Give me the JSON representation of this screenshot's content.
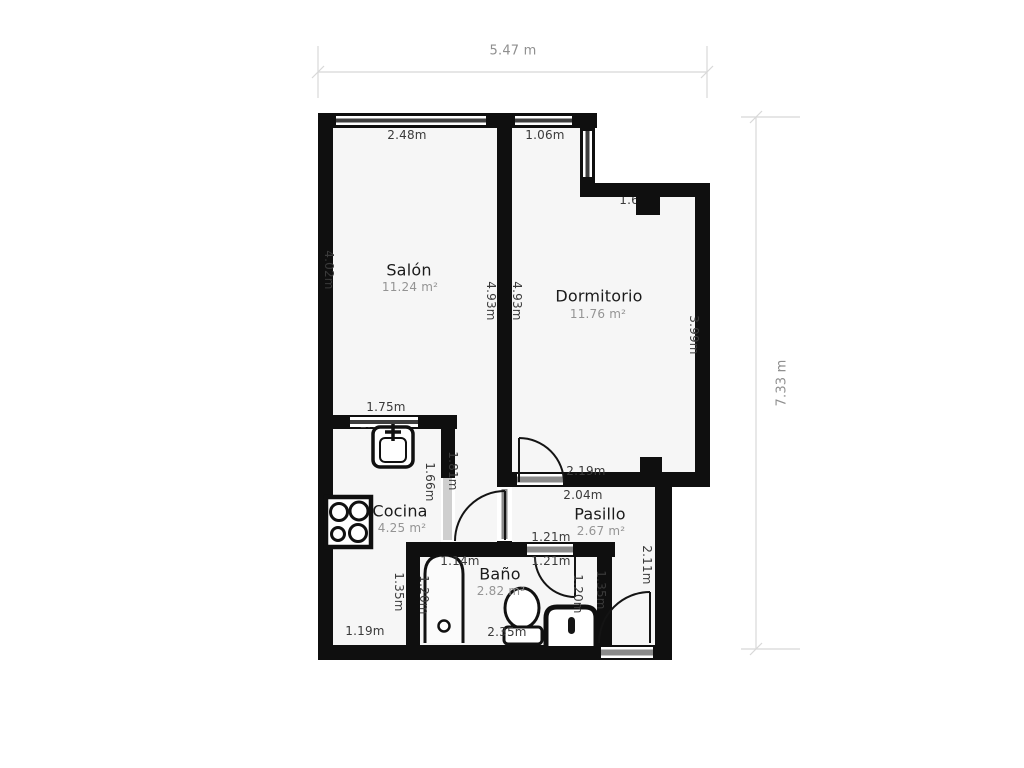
{
  "overall_dimensions": {
    "width": "5.47 m",
    "height": "7.33 m"
  },
  "rooms": {
    "salon": {
      "name": "Salón",
      "area": "11.24 m²"
    },
    "dormitorio": {
      "name": "Dormitorio",
      "area": "11.76 m²"
    },
    "cocina": {
      "name": "Cocina",
      "area": "4.25 m²"
    },
    "pasillo": {
      "name": "Pasillo",
      "area": "2.67 m²"
    },
    "bano": {
      "name": "Baño",
      "area": "2.82 m²"
    }
  },
  "measurements": {
    "salon_window": "2.48m",
    "dormitorio_window": "1.06m",
    "dormitorio_step": "1.64m",
    "salon_left_height": "4.02m",
    "salon_right_height": "4.93m",
    "dormitorio_left_height": "4.93m",
    "dormitorio_right_height": "3.99m",
    "cocina_window": "1.75m",
    "cocina_counter": "1.60m",
    "salon_passage_height": "1.81m",
    "cocina_door_height": "1.66m",
    "stove_width": "0.60m",
    "dormitorio_bottom_width": "2.19m",
    "pasillo_top_width": "2.04m",
    "bano_door_width_top": "1.21m",
    "bano_door_width_bottom": "1.21m",
    "bano_tub_width": "1.14m",
    "bano_left_height": "1.20m",
    "bano_right_height": "1.20m",
    "cocina_bano_wall_height": "1.35m",
    "pasillo_bano_wall_height": "1.35m",
    "pasillo_right_height": "2.11m",
    "bano_bottom_width": "2.35m",
    "cocina_bottom_width": "1.19m"
  },
  "colors": {
    "wall": "#0f0f0f",
    "floor": "#f6f6f6",
    "dimension_line": "#cfcfcf",
    "label_text": "#3a3a3a",
    "area_text": "#949494"
  }
}
